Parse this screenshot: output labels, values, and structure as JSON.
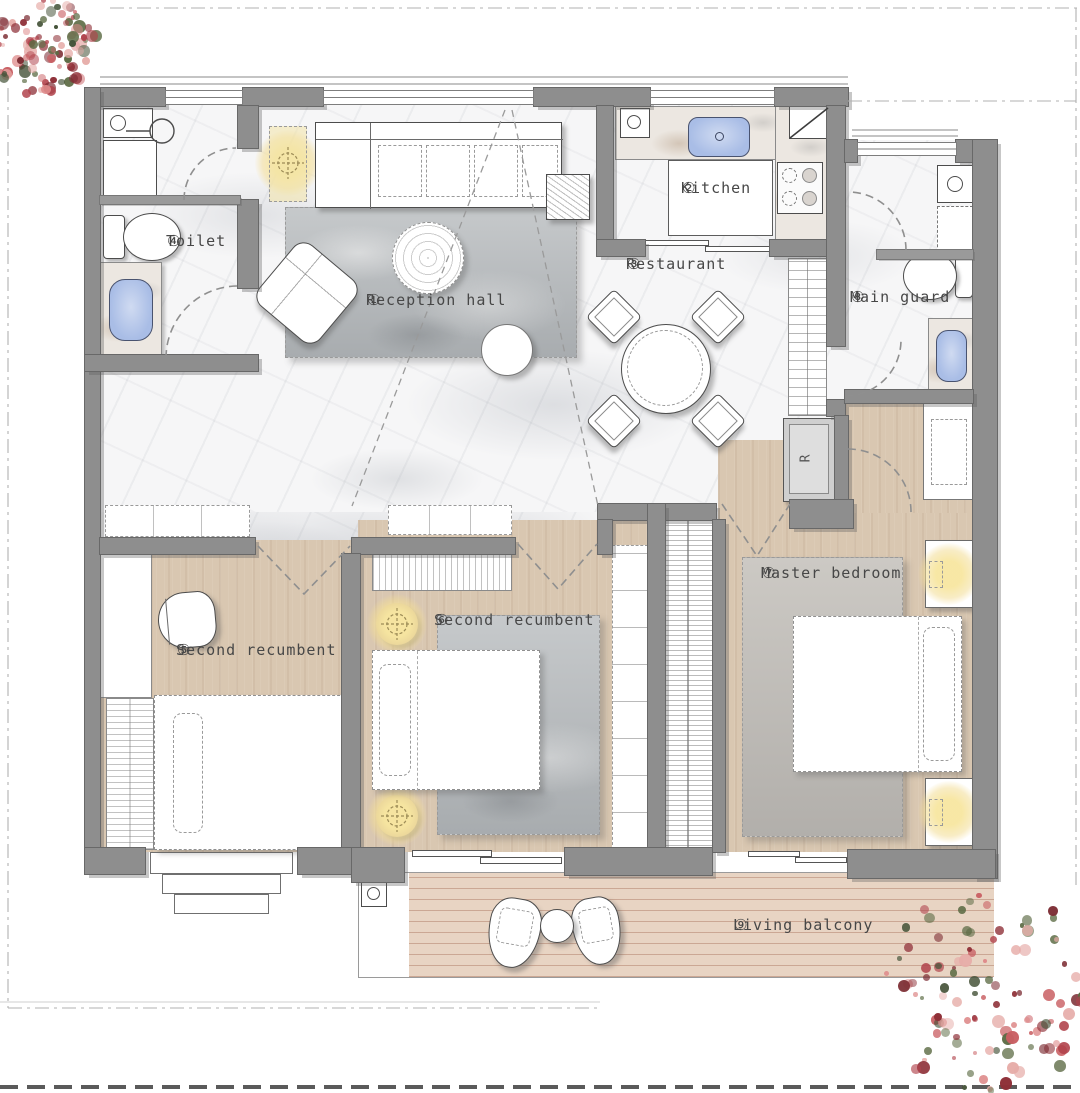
{
  "rooms": {
    "reception_hall": {
      "num": "①",
      "name": "Reception hall"
    },
    "kitchen": {
      "num": "②",
      "name": "Kitchen"
    },
    "restaurant": {
      "num": "③",
      "name": "Restaurant"
    },
    "toilet": {
      "num": "④",
      "name": "Toilet"
    },
    "second_recumbent_5": {
      "num": "⑤",
      "name": "Second recumbent"
    },
    "second_recumbent_6": {
      "num": "⑥",
      "name": "Second recumbent"
    },
    "master_bedroom": {
      "num": "⑦",
      "name": "Master bedroom"
    },
    "main_guard": {
      "num": "⑧",
      "name": "Main guard"
    },
    "living_balcony": {
      "num": "⑨",
      "name": "Living balcony"
    }
  },
  "fixtures": {
    "fridge_symbol": "R"
  },
  "icons": {
    "lamp": "crosshair-lamp-icon",
    "sink": "sink-icon",
    "washer": "washing-machine-icon",
    "toilet": "toilet-icon",
    "basin": "basin-icon",
    "cooktop": "cooktop-icon",
    "fridge": "refrigerator-icon",
    "plant": "plant-icon"
  },
  "colors": {
    "wall": "#8e8e8e",
    "wall_edge": "#686868",
    "wood_floor": "#d9c7b1",
    "deck_floor": "#e8d4c3",
    "marble_floor": "#f6f6f7",
    "rug": "#b9bdbf",
    "fixture_blue": "#a9bde6",
    "lamp_glow": "#f3dd96",
    "plant_red": "#b0424b",
    "label_text": "#474747"
  }
}
